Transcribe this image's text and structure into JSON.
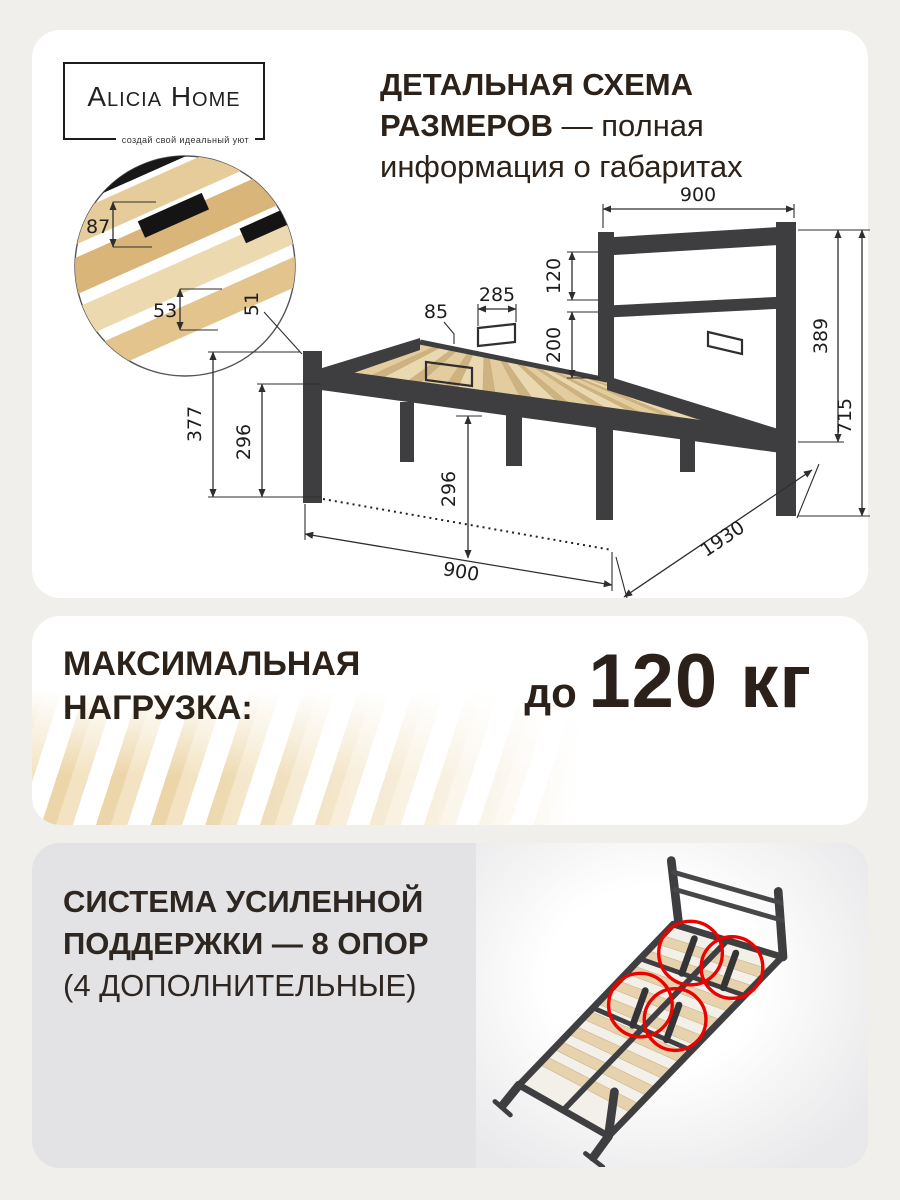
{
  "brand": {
    "name": "Alicia Home",
    "tagline": "создай свой идеальный уют"
  },
  "header": {
    "line1_bold": "ДЕТАЛЬНАЯ СХЕМА",
    "line2_bold": "РАЗМЕРОВ",
    "line2_rest": " — полная",
    "line3": "информация о габаритах"
  },
  "diagram": {
    "top_width": "900",
    "hb_gap1": "120",
    "hb_gap2": "200",
    "hb_height": "389",
    "total_height": "715",
    "slat_wide": "87",
    "slat_narrow": "53",
    "rail_lip": "51",
    "stopper_offset": "85",
    "stopper_width": "285",
    "foot_height": "377",
    "left_clearance": "296",
    "center_clearance": "296",
    "bottom_width": "900",
    "length": "1930"
  },
  "load": {
    "line1": "МАКСИМАЛЬНАЯ",
    "line2": "НАГРУЗКА:",
    "prefix": "до ",
    "value": "120 кг"
  },
  "support": {
    "line1": "СИСТЕМА УСИЛЕННОЙ",
    "line2": "ПОДДЕРЖКИ — 8 ОПОР",
    "line3": "(4 ДОПОЛНИТЕЛЬНЫЕ)"
  },
  "colors": {
    "accent_red": "#ec0000",
    "metal": "#3e3e40",
    "wood": "#e8d3a9",
    "text_dark": "#2d2219",
    "card_gray": "#e3e2e4",
    "page_bg": "#f0efeb"
  }
}
